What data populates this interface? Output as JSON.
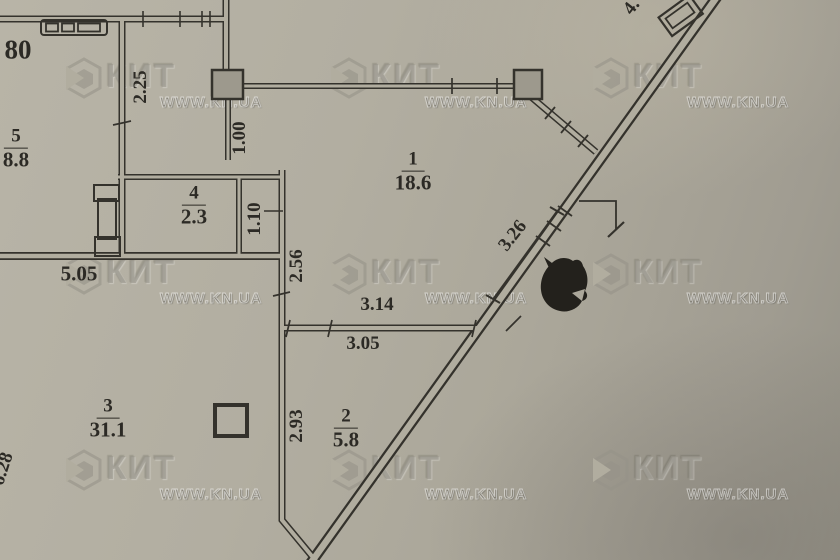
{
  "plan": {
    "rooms": [
      {
        "number": "1",
        "area": "18.6"
      },
      {
        "number": "2",
        "area": "5.8"
      },
      {
        "number": "3",
        "area": "31.1"
      },
      {
        "number": "4",
        "area": "2.3"
      },
      {
        "number": "5",
        "area": "8.8"
      }
    ],
    "dimensions": {
      "top_left_partial": "80",
      "d225": "2.25",
      "d100": "1.00",
      "d110": "1.10",
      "d505": "5.05",
      "d256": "2.56",
      "d314": "3.14",
      "d305": "3.05",
      "d326": "3.26",
      "d293": "2.93",
      "d628": "6.28",
      "top_right_partial": "4."
    }
  },
  "watermark": {
    "brand": "КИТ",
    "site": "WWW.KN.UA",
    "logo": "kit-hexagon-logo"
  },
  "colors": {
    "paper": "#b1ad9f",
    "ink": "#34322c"
  }
}
